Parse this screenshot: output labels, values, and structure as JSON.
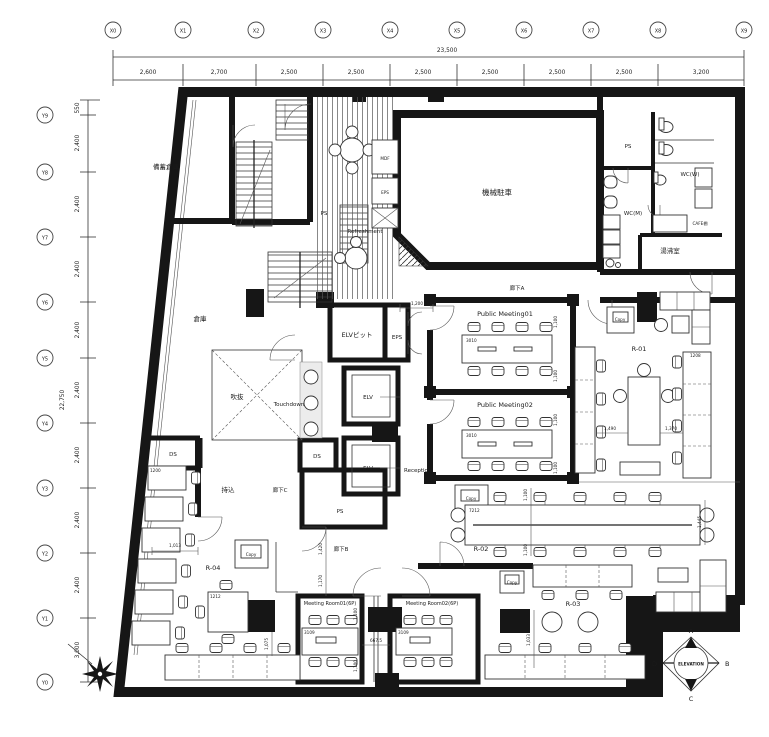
{
  "drawing": {
    "type": "architectural-floor-plan",
    "colors": {
      "wall": "#161616",
      "line": "#333333",
      "background": "#ffffff"
    }
  },
  "grid": {
    "x_labels": [
      "X0",
      "X1",
      "X2",
      "X3",
      "X4",
      "X5",
      "X6",
      "X7",
      "X8",
      "X9"
    ],
    "x_dims": [
      "2,600",
      "2,700",
      "2,500",
      "2,500",
      "2,500",
      "2,500",
      "2,500",
      "2,500",
      "3,200"
    ],
    "x_total": "23,500",
    "y_labels": [
      "Y9",
      "Y8",
      "Y7",
      "Y6",
      "Y5",
      "Y4",
      "Y3",
      "Y2",
      "Y1",
      "Y0"
    ],
    "y_dims": [
      "550",
      "2,400",
      "2,400",
      "2,400",
      "2,400",
      "2,400",
      "2,400",
      "2,400",
      "2,400",
      "3,000"
    ],
    "y_total": "22,750"
  },
  "rooms": {
    "bichiku_soko": "備蓄倉庫",
    "kikai_chusha": "機械駐車",
    "soko": "倉庫",
    "fukinuke": "吹抜",
    "refreshment": "Refreshment",
    "touchdown": "Touchdown",
    "mdf": "MDF",
    "eps": "EPS",
    "ps": "PS",
    "ds": "DS",
    "wc_w": "WC(W)",
    "wc_m": "WC(M)",
    "cafe_tana": "CAFE棚",
    "yuwakashi": "湯沸室",
    "elv_pit": "ELVピット",
    "elv": "ELV",
    "reception": "Reception",
    "mochikomi": "持込",
    "rouka_a": "廊下A",
    "rouka_b": "廊下B",
    "rouka_c": "廊下C",
    "public_meeting01": "Public Meeting01",
    "public_meeting02": "Public Meeting02",
    "meeting_room01": "Meeting Room01(6P)",
    "meeting_room02": "Meeting Room02(6P)",
    "r01": "R-01",
    "r02": "R-02",
    "r03": "R-03",
    "r04": "R-04",
    "copy": "Copy"
  },
  "dims": {
    "d1200": "1,200",
    "d1100": "1,100",
    "d1490": "1,490",
    "d1370": "1,370",
    "d1445": "1,445",
    "d1013": "1,013",
    "d1170": "1,170",
    "d1420": "1,420",
    "d1075": "1,075",
    "d667": "667.5",
    "d1033": "1,033"
  },
  "furniture_labels": {
    "t3010": "3010",
    "t7212": "7212",
    "t3109": "3109",
    "t1212": "1212",
    "t1208": "1208",
    "t1200": "1200"
  },
  "compass": {
    "label": "ELEVATION",
    "a": "A",
    "b": "B",
    "c": "C",
    "d": "D"
  }
}
